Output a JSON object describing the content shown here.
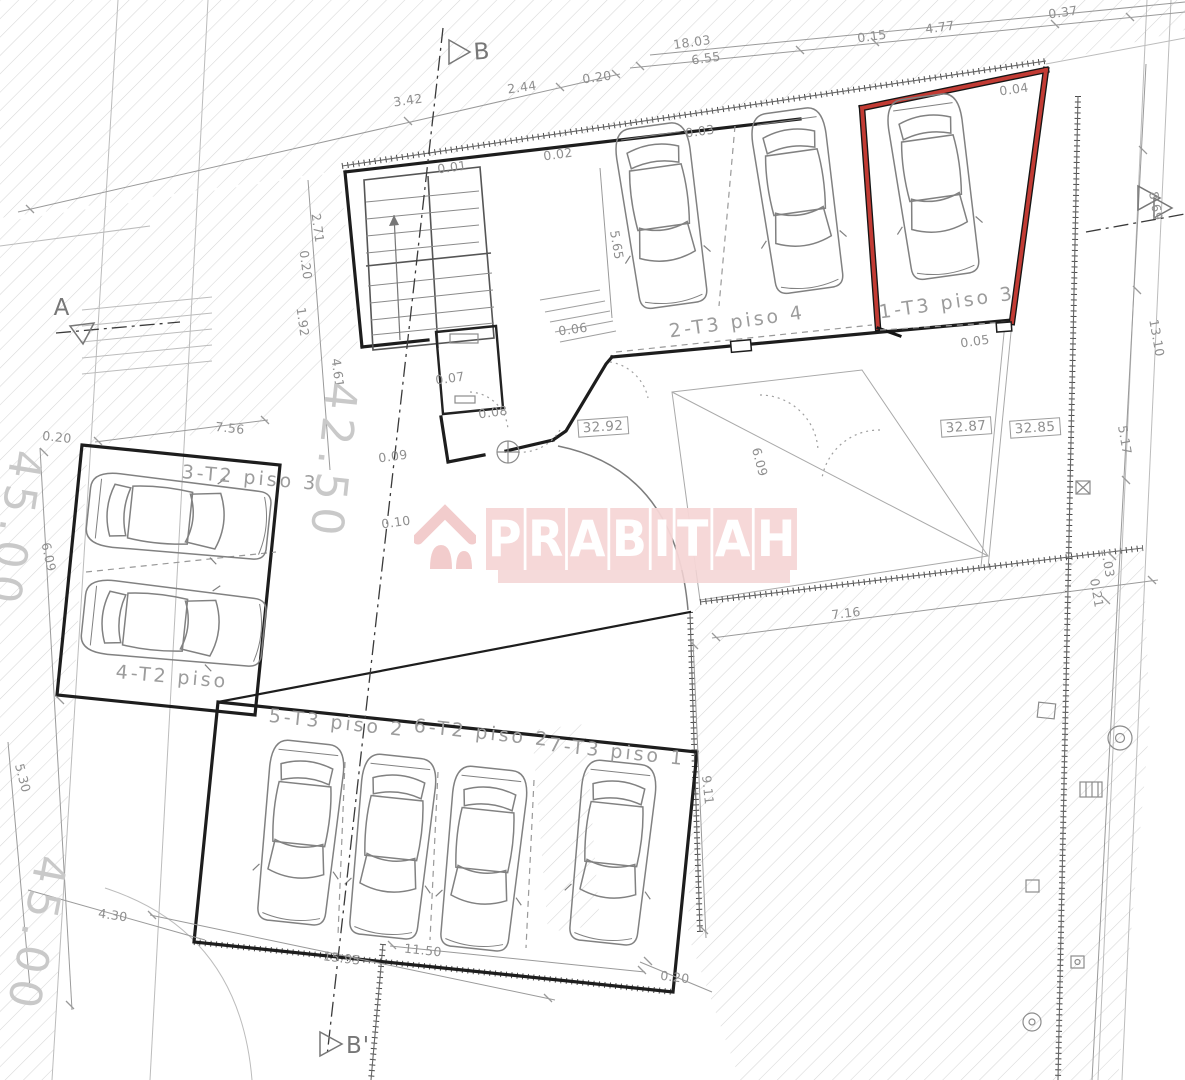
{
  "document": {
    "type": "architectural floor plan",
    "view": "parking / garage level"
  },
  "watermark": {
    "brand": "PRABITAH",
    "icon": "house-icon"
  },
  "colors": {
    "wall": "#1d1d1d",
    "highlight_red": "#c23b34",
    "dim_text": "#8f8f8f",
    "hatch": "#d7d7d7",
    "watermark_pink": "#f3d2d2"
  },
  "parking_spaces": [
    {
      "space": "1-T3 piso 3",
      "highlighted": true
    },
    {
      "space": "2-T3 piso 4",
      "highlighted": false
    },
    {
      "space": "3-T2 piso 3",
      "highlighted": false
    },
    {
      "space": "4-T2 piso",
      "highlighted": false
    },
    {
      "space": "5-T3 piso 2",
      "highlighted": false
    },
    {
      "space": "6-T2 piso 2",
      "highlighted": false
    },
    {
      "space": "7-T3 piso 1",
      "highlighted": false
    }
  ],
  "levels": [
    "32.92",
    "32.87",
    "32.85"
  ],
  "section_markers": [
    "B",
    "A",
    "B'"
  ],
  "labels": [
    {
      "t": "18.03",
      "x": 692,
      "y": 42,
      "r": -8,
      "k": "dim",
      "n": "dim-18-03"
    },
    {
      "t": "6.55",
      "x": 706,
      "y": 58,
      "r": -8,
      "k": "dim",
      "n": "dim-6-55"
    },
    {
      "t": "0.15",
      "x": 872,
      "y": 36,
      "r": -8,
      "k": "dim",
      "n": "dim-0-15"
    },
    {
      "t": "4.77",
      "x": 940,
      "y": 27,
      "r": -8,
      "k": "dim",
      "n": "dim-4-77"
    },
    {
      "t": "0.37",
      "x": 1063,
      "y": 12,
      "r": -8,
      "k": "dim",
      "n": "dim-0-37"
    },
    {
      "t": "0.20",
      "x": 597,
      "y": 77,
      "r": -8,
      "k": "dim",
      "n": "dim-0-20-top"
    },
    {
      "t": "3.42",
      "x": 408,
      "y": 100,
      "r": -8,
      "k": "dim",
      "n": "dim-3-42"
    },
    {
      "t": "2.44",
      "x": 522,
      "y": 87,
      "r": -8,
      "k": "dim",
      "n": "dim-2-44"
    },
    {
      "t": "0.01",
      "x": 452,
      "y": 167,
      "r": -8,
      "k": "dim",
      "n": "dim-0-01"
    },
    {
      "t": "0.02",
      "x": 558,
      "y": 154,
      "r": -8,
      "k": "dim",
      "n": "dim-0-02"
    },
    {
      "t": "0.03",
      "x": 700,
      "y": 131,
      "r": -8,
      "k": "dim",
      "n": "dim-0-03"
    },
    {
      "t": "0.04",
      "x": 1014,
      "y": 89,
      "r": -8,
      "k": "dim",
      "n": "dim-0-04"
    },
    {
      "t": "5.65",
      "x": 617,
      "y": 245,
      "r": 80,
      "k": "dim",
      "n": "dim-5-65"
    },
    {
      "t": "2.71",
      "x": 318,
      "y": 228,
      "r": 82,
      "k": "dim",
      "n": "dim-2-71"
    },
    {
      "t": "0.20",
      "x": 306,
      "y": 265,
      "r": 82,
      "k": "dim",
      "n": "dim-0-20-left"
    },
    {
      "t": "1.92",
      "x": 303,
      "y": 322,
      "r": 82,
      "k": "dim",
      "n": "dim-1-92"
    },
    {
      "t": "4.61",
      "x": 338,
      "y": 373,
      "r": 82,
      "k": "dim",
      "n": "dim-4-61"
    },
    {
      "t": "0.06",
      "x": 573,
      "y": 329,
      "r": -8,
      "k": "dim",
      "n": "dim-0-06"
    },
    {
      "t": "0.07",
      "x": 450,
      "y": 378,
      "r": -8,
      "k": "dim",
      "n": "dim-0-07"
    },
    {
      "t": "0.08",
      "x": 493,
      "y": 412,
      "r": -8,
      "k": "dim",
      "n": "dim-0-08"
    },
    {
      "t": "0.09",
      "x": 393,
      "y": 456,
      "r": -8,
      "k": "dim",
      "n": "dim-0-09"
    },
    {
      "t": "0.10",
      "x": 396,
      "y": 522,
      "r": -8,
      "k": "dim",
      "n": "dim-0-10"
    },
    {
      "t": "0.05",
      "x": 975,
      "y": 341,
      "r": -8,
      "k": "dim",
      "n": "dim-0-05"
    },
    {
      "t": "7.56",
      "x": 230,
      "y": 428,
      "r": 6,
      "k": "dim",
      "n": "dim-7-56"
    },
    {
      "t": "0.20",
      "x": 57,
      "y": 437,
      "r": 6,
      "k": "dim",
      "n": "dim-0-20-west"
    },
    {
      "t": "6.09",
      "x": 49,
      "y": 557,
      "r": 78,
      "k": "dim",
      "n": "dim-6-09-west"
    },
    {
      "t": "8.69",
      "x": 1156,
      "y": 206,
      "r": 80,
      "k": "dim",
      "n": "dim-8-69"
    },
    {
      "t": "13.10",
      "x": 1157,
      "y": 338,
      "r": 80,
      "k": "dim",
      "n": "dim-13-10"
    },
    {
      "t": "5.17",
      "x": 1125,
      "y": 440,
      "r": 80,
      "k": "dim",
      "n": "dim-5-17"
    },
    {
      "t": "1.03",
      "x": 1108,
      "y": 563,
      "r": 80,
      "k": "dim",
      "n": "dim-1-03"
    },
    {
      "t": "0.21",
      "x": 1097,
      "y": 593,
      "r": 80,
      "k": "dim",
      "n": "dim-0-21"
    },
    {
      "t": "7.16",
      "x": 846,
      "y": 613,
      "r": -7,
      "k": "dim",
      "n": "dim-7-16"
    },
    {
      "t": "6.09",
      "x": 760,
      "y": 462,
      "r": 75,
      "k": "dim",
      "n": "dim-6-09-court"
    },
    {
      "t": "9.11",
      "x": 708,
      "y": 790,
      "r": 84,
      "k": "dim",
      "n": "dim-9-11"
    },
    {
      "t": "4.30",
      "x": 113,
      "y": 915,
      "r": 8,
      "k": "dim",
      "n": "dim-4-30"
    },
    {
      "t": "5.30",
      "x": 23,
      "y": 778,
      "r": 75,
      "k": "dim",
      "n": "dim-5-30"
    },
    {
      "t": "15.95",
      "x": 342,
      "y": 958,
      "r": 7,
      "k": "dim",
      "n": "dim-15-95"
    },
    {
      "t": "11.50",
      "x": 423,
      "y": 950,
      "r": 6,
      "k": "dim",
      "n": "dim-11-50"
    },
    {
      "t": "0.20",
      "x": 675,
      "y": 977,
      "r": 7,
      "k": "dim",
      "n": "dim-0-20-bottom"
    },
    {
      "t": "2-T3 piso 4",
      "x": 737,
      "y": 322,
      "r": -8,
      "k": "room",
      "n": "space-label-2-t3"
    },
    {
      "t": "1-T3 piso 3",
      "x": 947,
      "y": 303,
      "r": -8,
      "k": "room",
      "n": "space-label-1-t3"
    },
    {
      "t": "3-T2 piso 3",
      "x": 250,
      "y": 478,
      "r": 5,
      "k": "room",
      "n": "space-label-3-t2"
    },
    {
      "t": "4-T2 piso",
      "x": 172,
      "y": 677,
      "r": 5,
      "k": "room",
      "n": "space-label-4-t2"
    },
    {
      "t": "5-T3 piso 2",
      "x": 337,
      "y": 723,
      "r": 6,
      "k": "room",
      "n": "space-label-5-t3"
    },
    {
      "t": "6-T2 piso 2",
      "x": 482,
      "y": 733,
      "r": 6,
      "k": "room",
      "n": "space-label-6-t2"
    },
    {
      "t": "7-T3 piso 1",
      "x": 617,
      "y": 752,
      "r": 6,
      "k": "room",
      "n": "space-label-7-t3"
    },
    {
      "t": "32.92",
      "x": 603,
      "y": 427,
      "r": -4,
      "k": "level",
      "n": "level-32-92"
    },
    {
      "t": "32.87",
      "x": 966,
      "y": 427,
      "r": -4,
      "k": "level",
      "n": "level-32-87"
    },
    {
      "t": "32.85",
      "x": 1035,
      "y": 428,
      "r": -4,
      "k": "level",
      "n": "level-32-85"
    },
    {
      "t": "42.50",
      "x": 333,
      "y": 462,
      "r": 96,
      "k": "street",
      "n": "street-level-42-50"
    },
    {
      "t": "45.00",
      "x": 14,
      "y": 530,
      "r": 99,
      "k": "street",
      "n": "street-level-45-00-a"
    },
    {
      "t": "45.00",
      "x": 36,
      "y": 935,
      "r": 101,
      "k": "street",
      "n": "street-level-45-00-b"
    },
    {
      "t": "B",
      "x": 482,
      "y": 52,
      "r": -4,
      "k": "marker",
      "n": "section-marker-b"
    },
    {
      "t": "A",
      "x": 62,
      "y": 308,
      "r": 0,
      "k": "marker",
      "n": "section-marker-a"
    },
    {
      "t": "B'",
      "x": 358,
      "y": 1046,
      "r": 0,
      "k": "marker",
      "n": "section-marker-b-prime"
    }
  ]
}
